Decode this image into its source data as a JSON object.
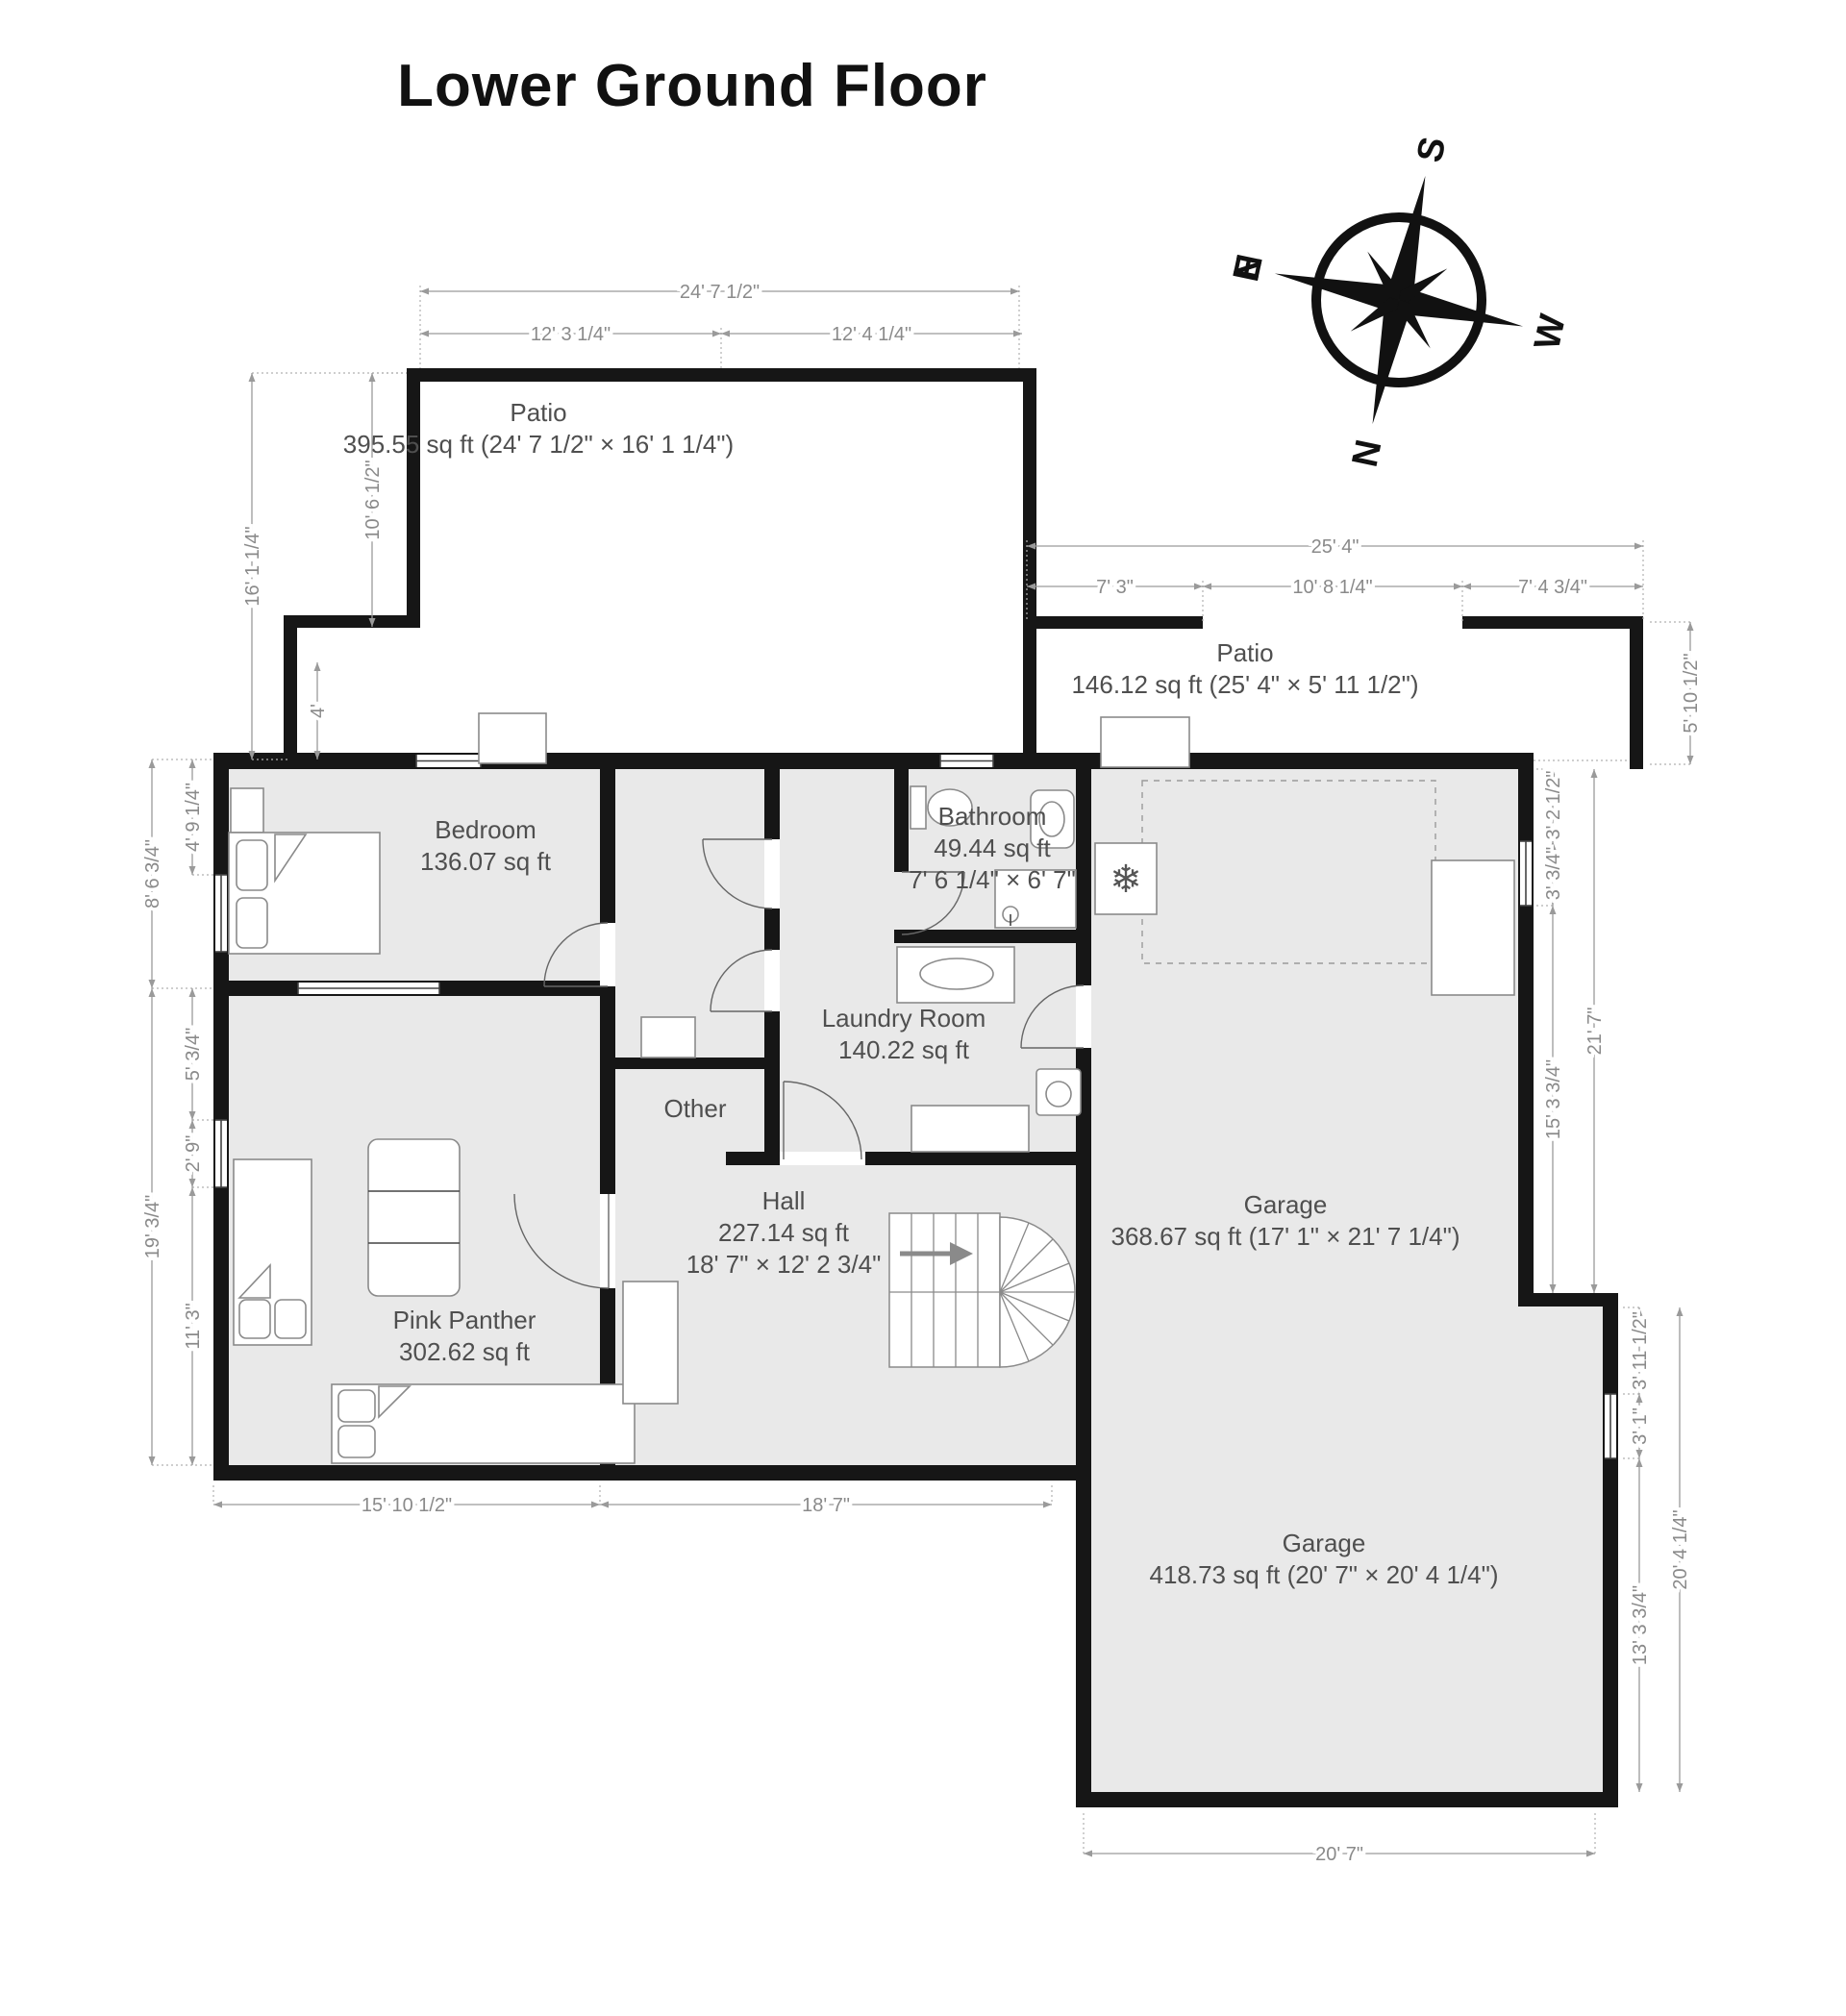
{
  "title": "Lower Ground Floor",
  "compass": {
    "n": "N",
    "e": "E",
    "s": "S",
    "w": "W"
  },
  "icons": {
    "freezer": "❄"
  },
  "colors": {
    "wall": "#161616",
    "floor": "#e9e9e9",
    "dimension": "#8a8a8a",
    "room_label": "#4f4f4f",
    "stairs_arrow": "#8a8a8a"
  },
  "rooms": {
    "patio_top": {
      "name": "Patio",
      "line2": "395.55 sq ft (24' 7 1/2\" × 16' 1 1/4\")"
    },
    "patio_right": {
      "name": "Patio",
      "line2": "146.12 sq ft (25' 4\" × 5' 11 1/2\")"
    },
    "bedroom": {
      "name": "Bedroom",
      "line2": "136.07 sq ft"
    },
    "bathroom": {
      "name": "Bathroom",
      "line2": "49.44 sq ft",
      "line3": "7' 6 1/4\" × 6' 7\""
    },
    "laundry": {
      "name": "Laundry Room",
      "line2": "140.22 sq ft"
    },
    "other": {
      "name": "Other"
    },
    "hall": {
      "name": "Hall",
      "line2": "227.14 sq ft",
      "line3": "18' 7\" × 12' 2 3/4\""
    },
    "pink_panther": {
      "name": "Pink Panther",
      "line2": "302.62 sq ft"
    },
    "garage_upper": {
      "name": "Garage",
      "line2": "368.67 sq ft (17' 1\" × 21' 7 1/4\")"
    },
    "garage_lower": {
      "name": "Garage",
      "line2": "418.73 sq ft (20' 7\" × 20' 4 1/4\")"
    }
  },
  "dimensions": {
    "top_patio_width": "24' 7 1/2\"",
    "top_patio_w_left": "12' 3 1/4\"",
    "top_patio_w_right": "12' 4 1/4\"",
    "top_patio_height": "16' 1 1/4\"",
    "top_patio_h_upper": "10' 6 1/2\"",
    "top_patio_h_lower": "4'",
    "right_patio_width": "25' 4\"",
    "right_patio_w1": "7' 3\"",
    "right_patio_w2": "10' 8 1/4\"",
    "right_patio_w3": "7' 4 3/4\"",
    "right_patio_height": "5' 10 1/2\"",
    "bedroom_left": "8' 6 3/4\"",
    "bedroom_left_upper": "4' 9 1/4\"",
    "pp_left": "19' 3/4\"",
    "pp_left_1": "5' 3/4\"",
    "pp_left_2": "2' 9\"",
    "pp_left_3": "11' 3\"",
    "bottom_pp": "15' 10 1/2\"",
    "bottom_hall": "18' 7\"",
    "garage_up_right_outer": "21' 7\"",
    "garage_up_right_1": "3' 2 1/2\"",
    "garage_up_right_2": "3' 3/4\"",
    "garage_up_right_3": "15' 3 3/4\"",
    "garage_lo_right_outer": "20' 4 1/4\"",
    "garage_lo_right_1": "3' 11 1/2\"",
    "garage_lo_right_2": "3' 1\"",
    "garage_lo_right_3": "13' 3 3/4\"",
    "garage_lo_bottom": "20' 7\""
  }
}
